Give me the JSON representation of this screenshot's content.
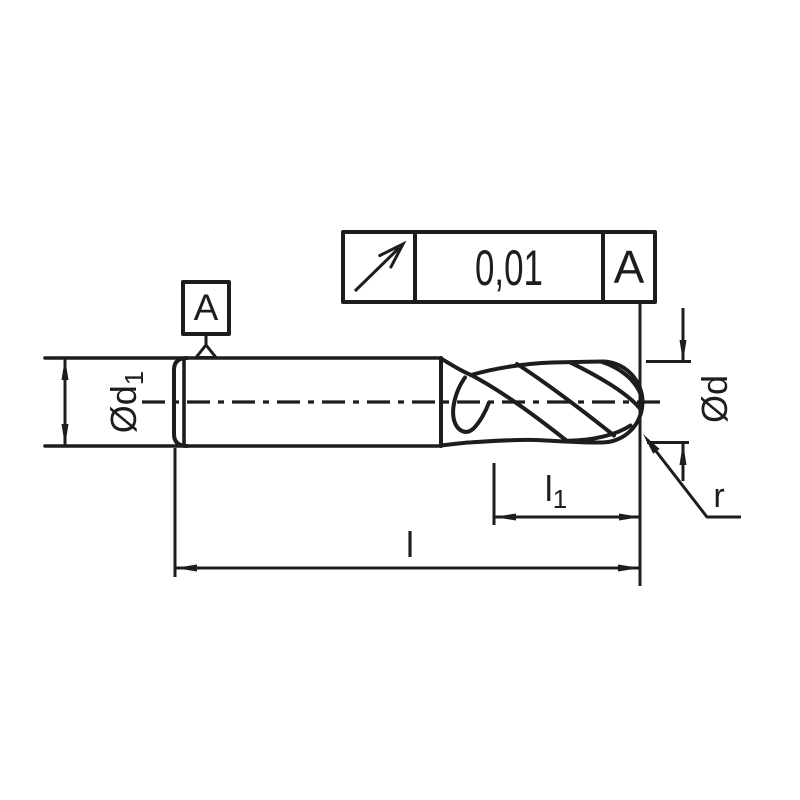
{
  "colors": {
    "background": "#ffffff",
    "line": "#1d1d1b"
  },
  "tolerance_frame": {
    "symbol_icon": "circular-runout-arrow",
    "value": "0,01",
    "datum": "A"
  },
  "datum_flag": {
    "label": "A"
  },
  "dimensions": {
    "shank_diameter": {
      "main": "Ød",
      "sub": "1"
    },
    "cutting_diameter": {
      "main": "Ød"
    },
    "flute_length": {
      "main": "l",
      "sub": "1"
    },
    "overall_length": {
      "main": "l"
    },
    "corner_radius": {
      "main": "r"
    }
  }
}
